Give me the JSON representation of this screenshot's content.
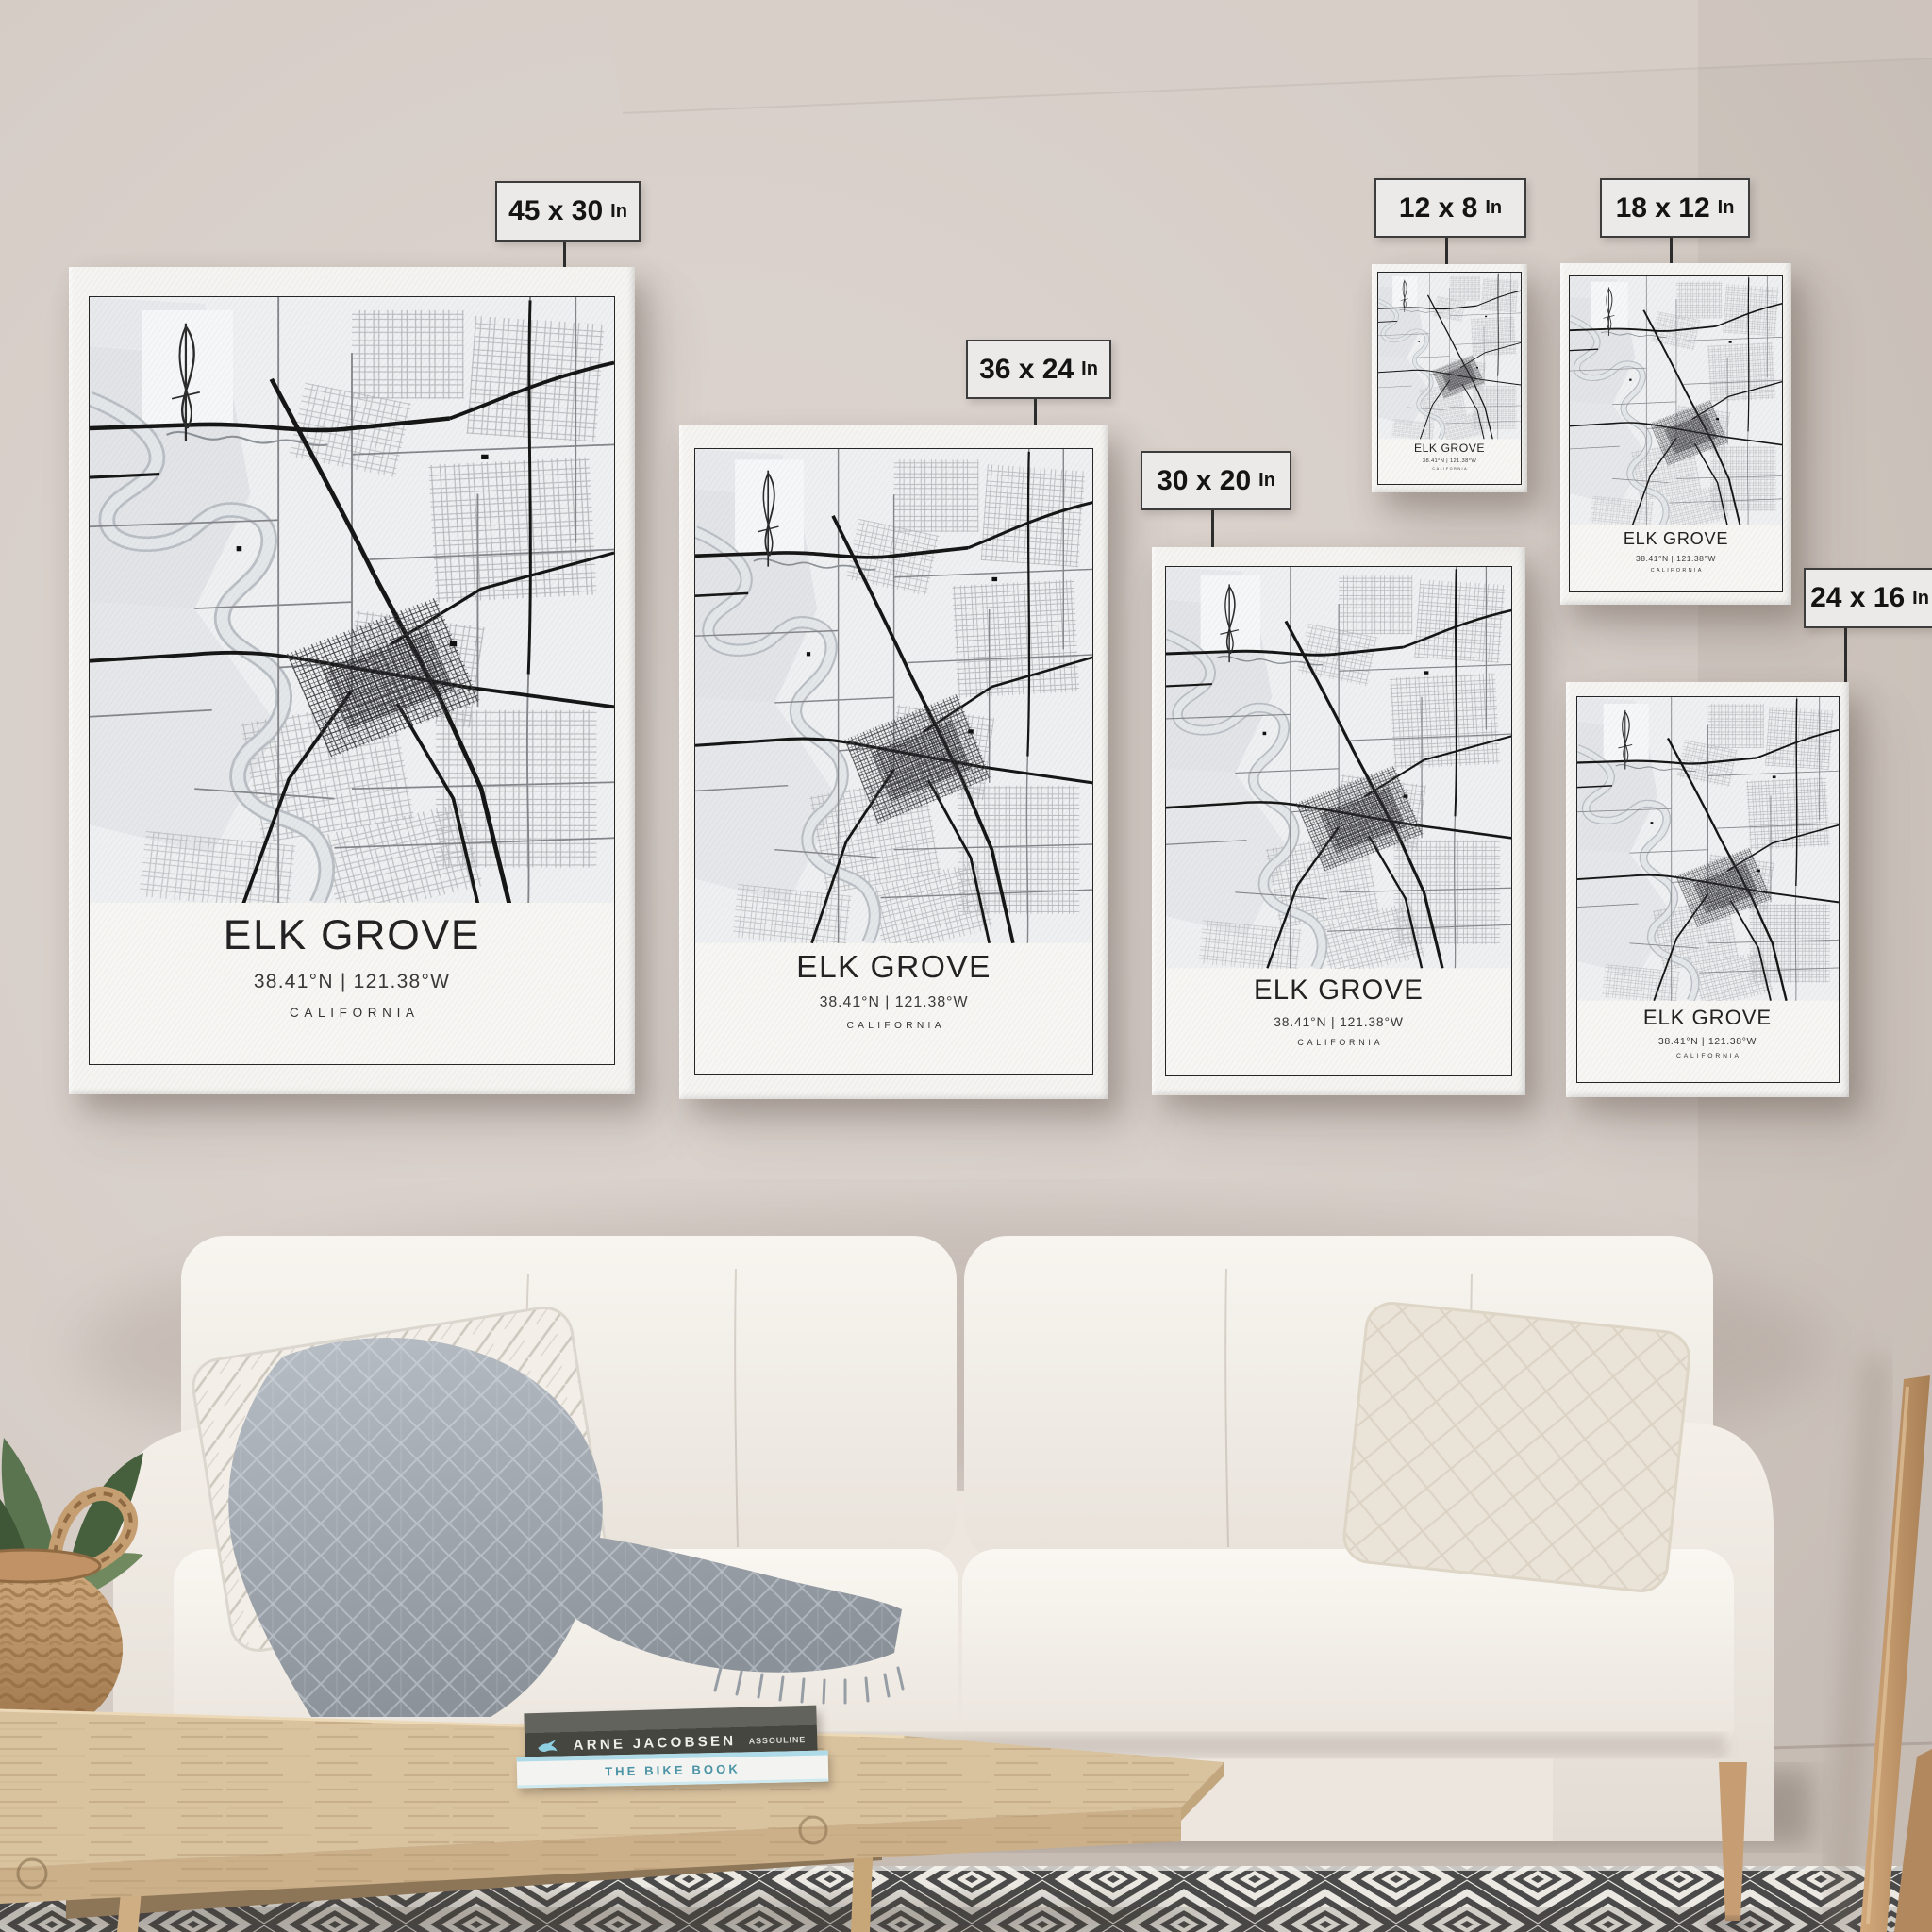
{
  "scene": {
    "description": "Living room wall mockup: six Elk Grove city map canvases above a white sofa",
    "wall_color": "#d6cdc7",
    "label_bg": "#ebeae8",
    "label_border": "#3c3c3c",
    "poster_bg": "#f5f4f1",
    "map_ink": "#1a1a1a",
    "rug_ink": "#4a4a4a",
    "wood_color": "#d9c29e",
    "book1_accent": "#8ecfe2",
    "book2_accent": "#4b93a5"
  },
  "posters": [
    {
      "id": "45x30",
      "size": "45 x 30",
      "unit": "In",
      "title": "ELK GROVE",
      "coordinates": "38.41°N | 121.38°W",
      "region": "CALIFORNIA"
    },
    {
      "id": "36x24",
      "size": "36 x 24",
      "unit": "In",
      "title": "ELK GROVE",
      "coordinates": "38.41°N | 121.38°W",
      "region": "CALIFORNIA"
    },
    {
      "id": "30x20",
      "size": "30 x 20",
      "unit": "In",
      "title": "ELK GROVE",
      "coordinates": "38.41°N | 121.38°W",
      "region": "CALIFORNIA"
    },
    {
      "id": "12x8",
      "size": "12 x 8",
      "unit": "In",
      "title": "ELK GROVE",
      "coordinates": "38.41°N | 121.38°W",
      "region": "CALIFORNIA"
    },
    {
      "id": "18x12",
      "size": "18 x 12",
      "unit": "In",
      "title": "ELK GROVE",
      "coordinates": "38.41°N | 121.38°W",
      "region": "CALIFORNIA"
    },
    {
      "id": "24x16",
      "size": "24 x 16",
      "unit": "In",
      "title": "ELK GROVE",
      "coordinates": "38.41°N | 121.38°W",
      "region": "CALIFORNIA"
    }
  ],
  "books": [
    {
      "title": "ARNE JACOBSEN",
      "publisher": "ASSOULINE"
    },
    {
      "title": "THE BIKE BOOK"
    }
  ]
}
